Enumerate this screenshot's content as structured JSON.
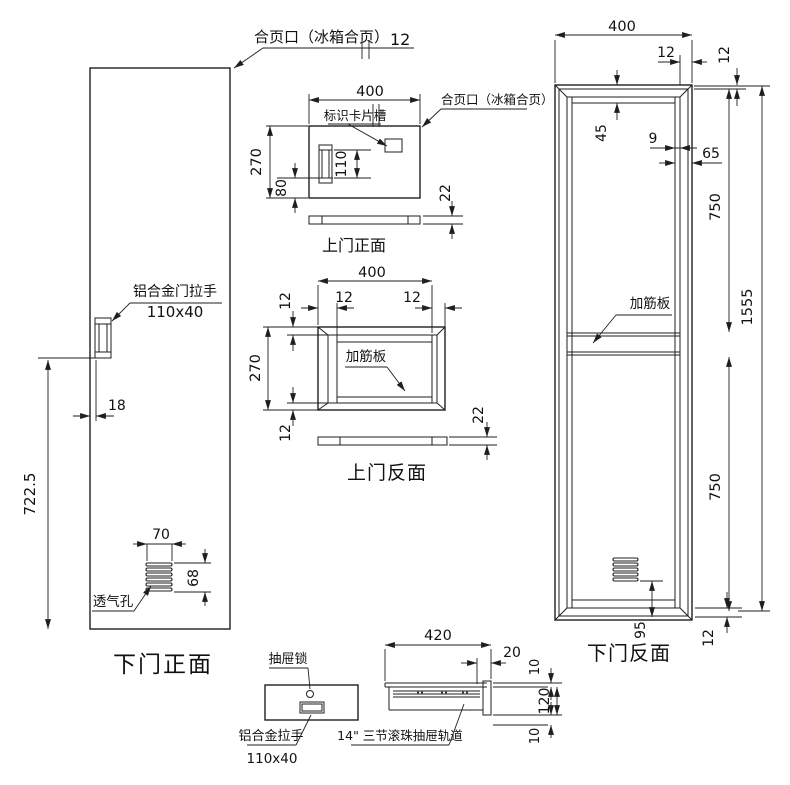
{
  "drawing": {
    "background": "#ffffff",
    "line_color": "#1f1f1f"
  },
  "labels": {
    "hinge_top": "合页口（冰箱合页）",
    "hinge_upper": "合页口（冰箱合页）",
    "card_slot": "标识卡片槽",
    "rib_upper_back": "加筋板",
    "rib_lower_back": "加筋板",
    "door_handle": "铝合金门拉手",
    "door_handle_size": "110x40",
    "vent": "透气孔",
    "drawer_lock": "抽屉锁",
    "drawer_handle": "铝合金拉手",
    "drawer_handle_size": "110x40",
    "drawer_rail": "14\" 三节滚珠抽屉轨道"
  },
  "captions": {
    "upper_front": "上门正面",
    "upper_back": "上门反面",
    "lower_front": "下门正面",
    "lower_back": "下门反面"
  },
  "dims": {
    "top_hinge_offset": "12",
    "uf_width": "400",
    "uf_height": "270",
    "uf_handle_h": "110",
    "uf_bottom": "80",
    "uf_thickness": "22",
    "ub_width": "400",
    "ub_left": "12",
    "ub_right": "12",
    "ub_top": "12",
    "ub_height": "270",
    "ub_bottom": "12",
    "ub_thickness": "22",
    "lf_offset": "18",
    "lf_pos": "722.5",
    "lf_vent_w": "70",
    "lf_vent_h": "68",
    "lb_width": "400",
    "lb_top_right": "12",
    "lb_right_edge": "12",
    "lb_hinge": "45",
    "lb_strip": "9",
    "lb_edge": "65",
    "lb_up": "750",
    "lb_total": "1555",
    "lb_low": "750",
    "lb_vent": "95",
    "lb_bottom": "12",
    "dr_width": "420",
    "dr_cap": "20",
    "dr_top": "10",
    "dr_height": "120",
    "dr_bottom": "10"
  }
}
